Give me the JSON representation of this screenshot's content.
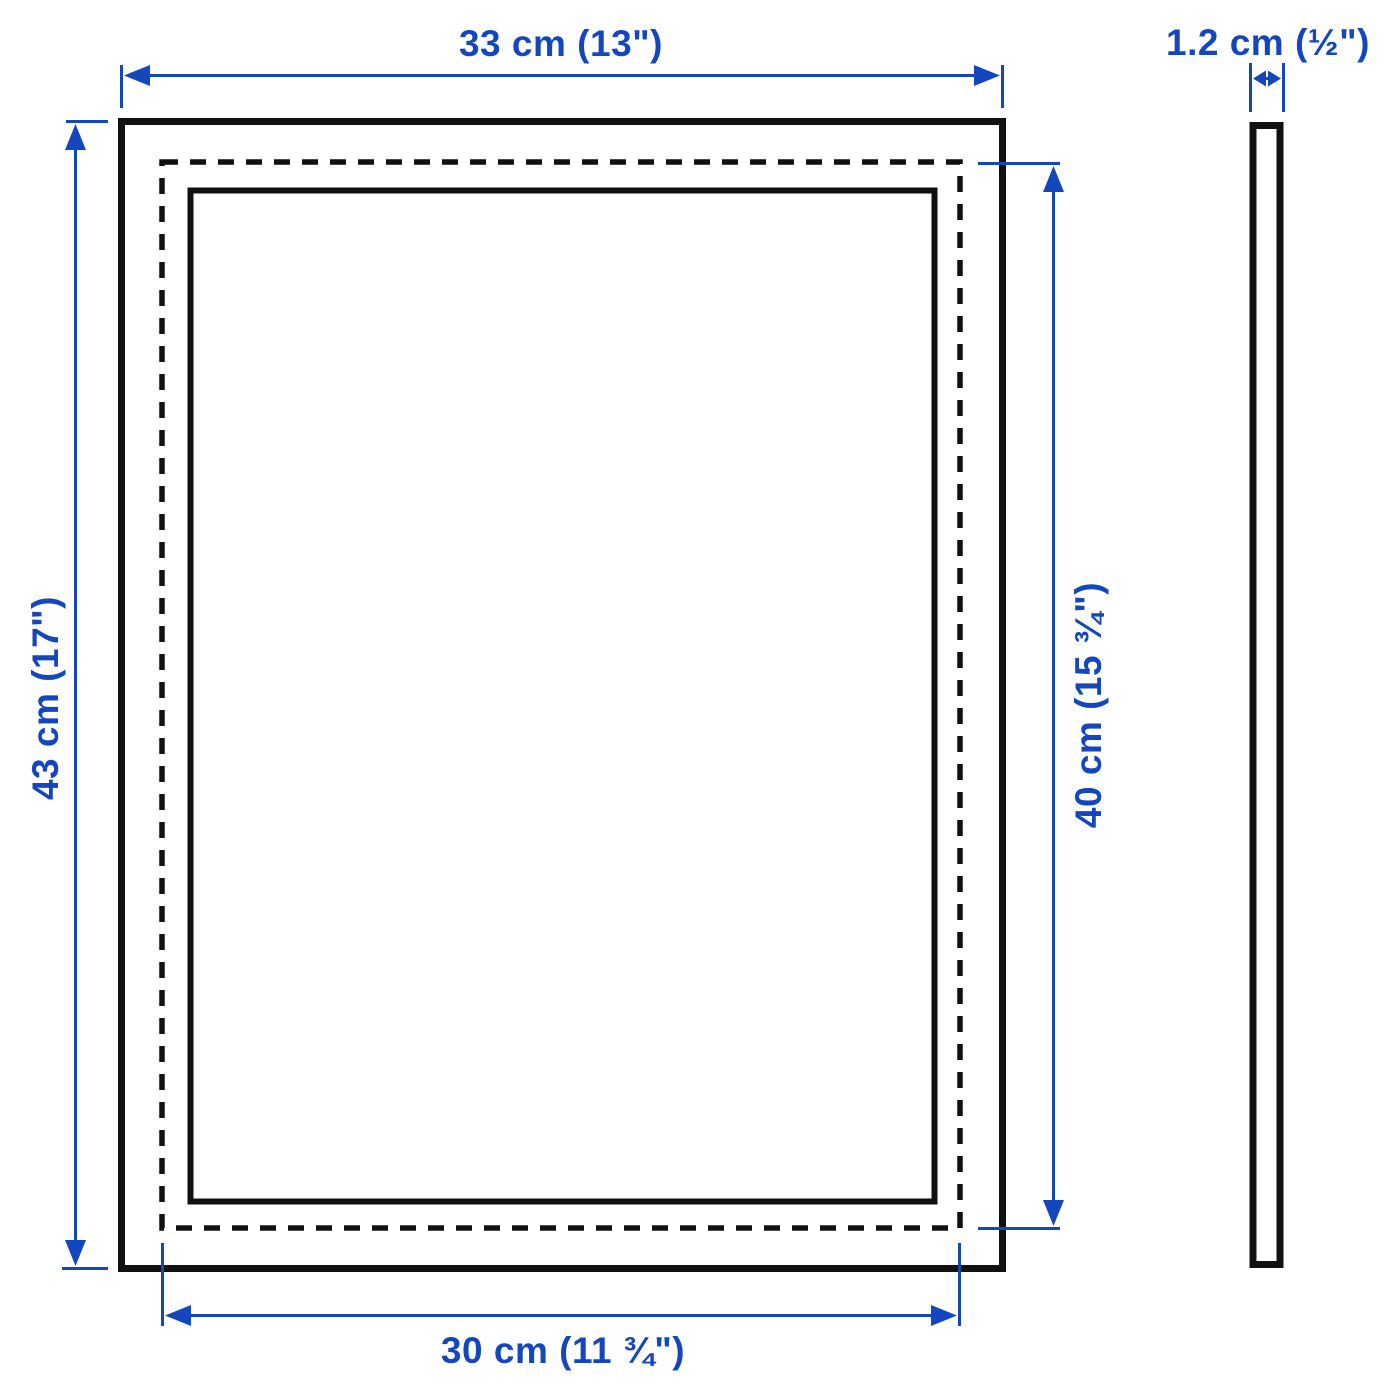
{
  "diagram": {
    "title": "Frame dimension drawing, front and side view",
    "colors": {
      "dimension": "#1447bd",
      "outline": "#111111",
      "background": "#ffffff"
    },
    "front_view": {
      "frame_width_label": "33 cm (13\")",
      "frame_height_label": "43 cm (17\")",
      "picture_height_label": "40 cm (15 ¾\")",
      "picture_width_label": "30 cm (11 ¾\")"
    },
    "side_view": {
      "depth_label": "1.2 cm (½\")"
    }
  }
}
